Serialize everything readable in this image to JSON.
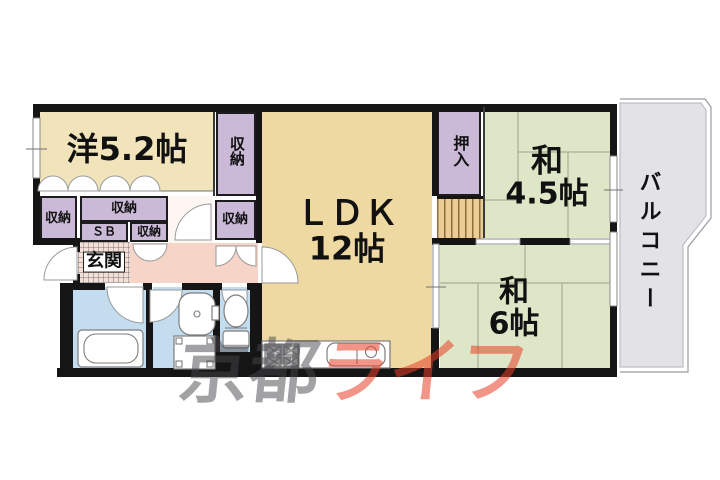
{
  "plan": {
    "rooms": {
      "western": {
        "label": "洋5.2帖"
      },
      "ldk": {
        "line1": "ＬＤＫ",
        "line2": "12帖"
      },
      "jp45": {
        "line1": "和",
        "line2": "4.5帖"
      },
      "jp6": {
        "line1": "和",
        "line2": "6帖"
      },
      "balcony": {
        "label": "バルコニー"
      },
      "entrance": {
        "label": "玄関"
      },
      "oshiire": {
        "label": "押入"
      },
      "sb": {
        "label": "ＳＢ"
      },
      "storage_left": {
        "label": "収納"
      },
      "storage_wide": {
        "label": "収納"
      },
      "storage_small": {
        "label": "収納"
      },
      "storage_column": {
        "label": "収納"
      },
      "storage_column_lower": {
        "label": "収納"
      }
    },
    "watermark": {
      "part1": "京都",
      "part2": "ライフ"
    },
    "colors": {
      "wall": "#151515",
      "western": "#f1e4ba",
      "ldk": "#eed9a2",
      "tatami": "#dde6c7",
      "storage": "#cbb9d8",
      "corridor": "#f7d4c8",
      "entrance_floor": "#f3ded8",
      "wet": "#c3dcee",
      "balcony": "#e2e2e7",
      "stripe_area": "#eace96",
      "watermark_gray": "rgba(70,70,75,0.5)",
      "watermark_red": "rgba(232,62,38,0.55)"
    }
  }
}
